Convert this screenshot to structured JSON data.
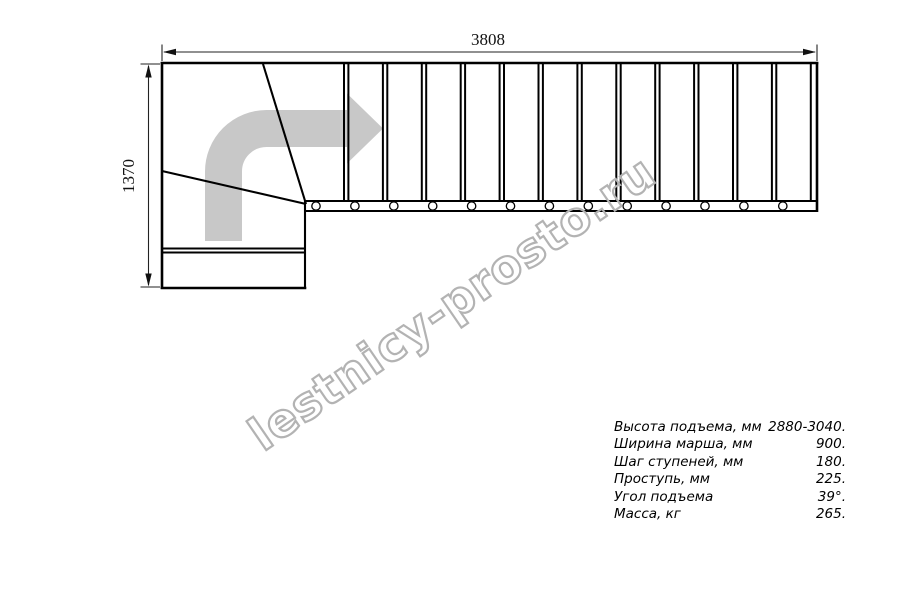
{
  "drawing": {
    "dimensions": {
      "total_length": "3808",
      "total_width": "1370"
    },
    "flight": {
      "tread_count": 13
    },
    "colors": {
      "line": "#000000",
      "arrow": "#c8c8c8",
      "watermark_outline": "#b3b3b3"
    }
  },
  "watermark": {
    "text": "lestnicy-prosto.ru"
  },
  "specs": {
    "rows": [
      {
        "label": "Высота подъема, мм",
        "value": "2880-3040."
      },
      {
        "label": "Ширина марша, мм",
        "value": "900."
      },
      {
        "label": "Шаг ступеней, мм",
        "value": "180."
      },
      {
        "label": "Проступь, мм",
        "value": "225."
      },
      {
        "label": "Угол подъема",
        "value": "39°."
      },
      {
        "label": "Масса, кг",
        "value": "265."
      }
    ]
  }
}
